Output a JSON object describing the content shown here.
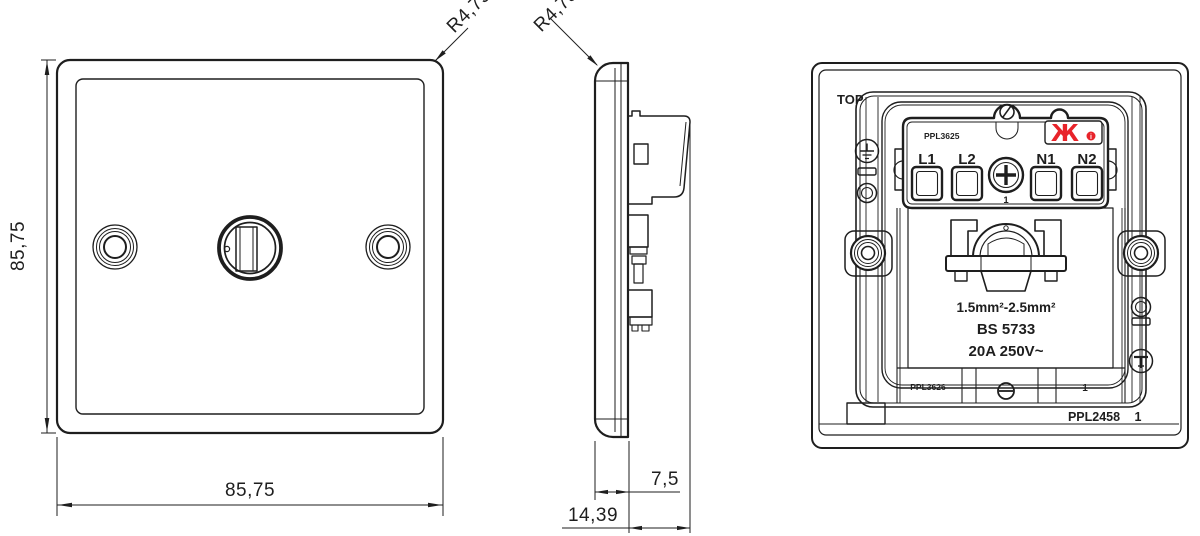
{
  "drawing": {
    "front": {
      "dim_height": "85,75",
      "dim_width": "85,75",
      "corner_radius": "R4,75"
    },
    "side": {
      "corner_radius": "R4,75",
      "dim_plate_depth": "7,5",
      "dim_total_depth": "14,39"
    },
    "back": {
      "orientation": "TOP",
      "module_part_no": "PPL3625",
      "module_part_no_2": "PPL3626",
      "plate_part_no": "PPL2458",
      "plate_sheet_no": "1",
      "terminal_labels": [
        "L1",
        "L2",
        "N1",
        "N2"
      ],
      "centre_screw_no": "1",
      "strip_cell_no": "1",
      "conductor_range": "1.5mm²-2.5mm²",
      "standard": "BS 5733",
      "rating": "20A  250V~",
      "brand_glyph": "Ж",
      "info_glyph": "i"
    },
    "colors": {
      "line": "#1e1e1e",
      "brand_red": "#e8232a"
    }
  }
}
